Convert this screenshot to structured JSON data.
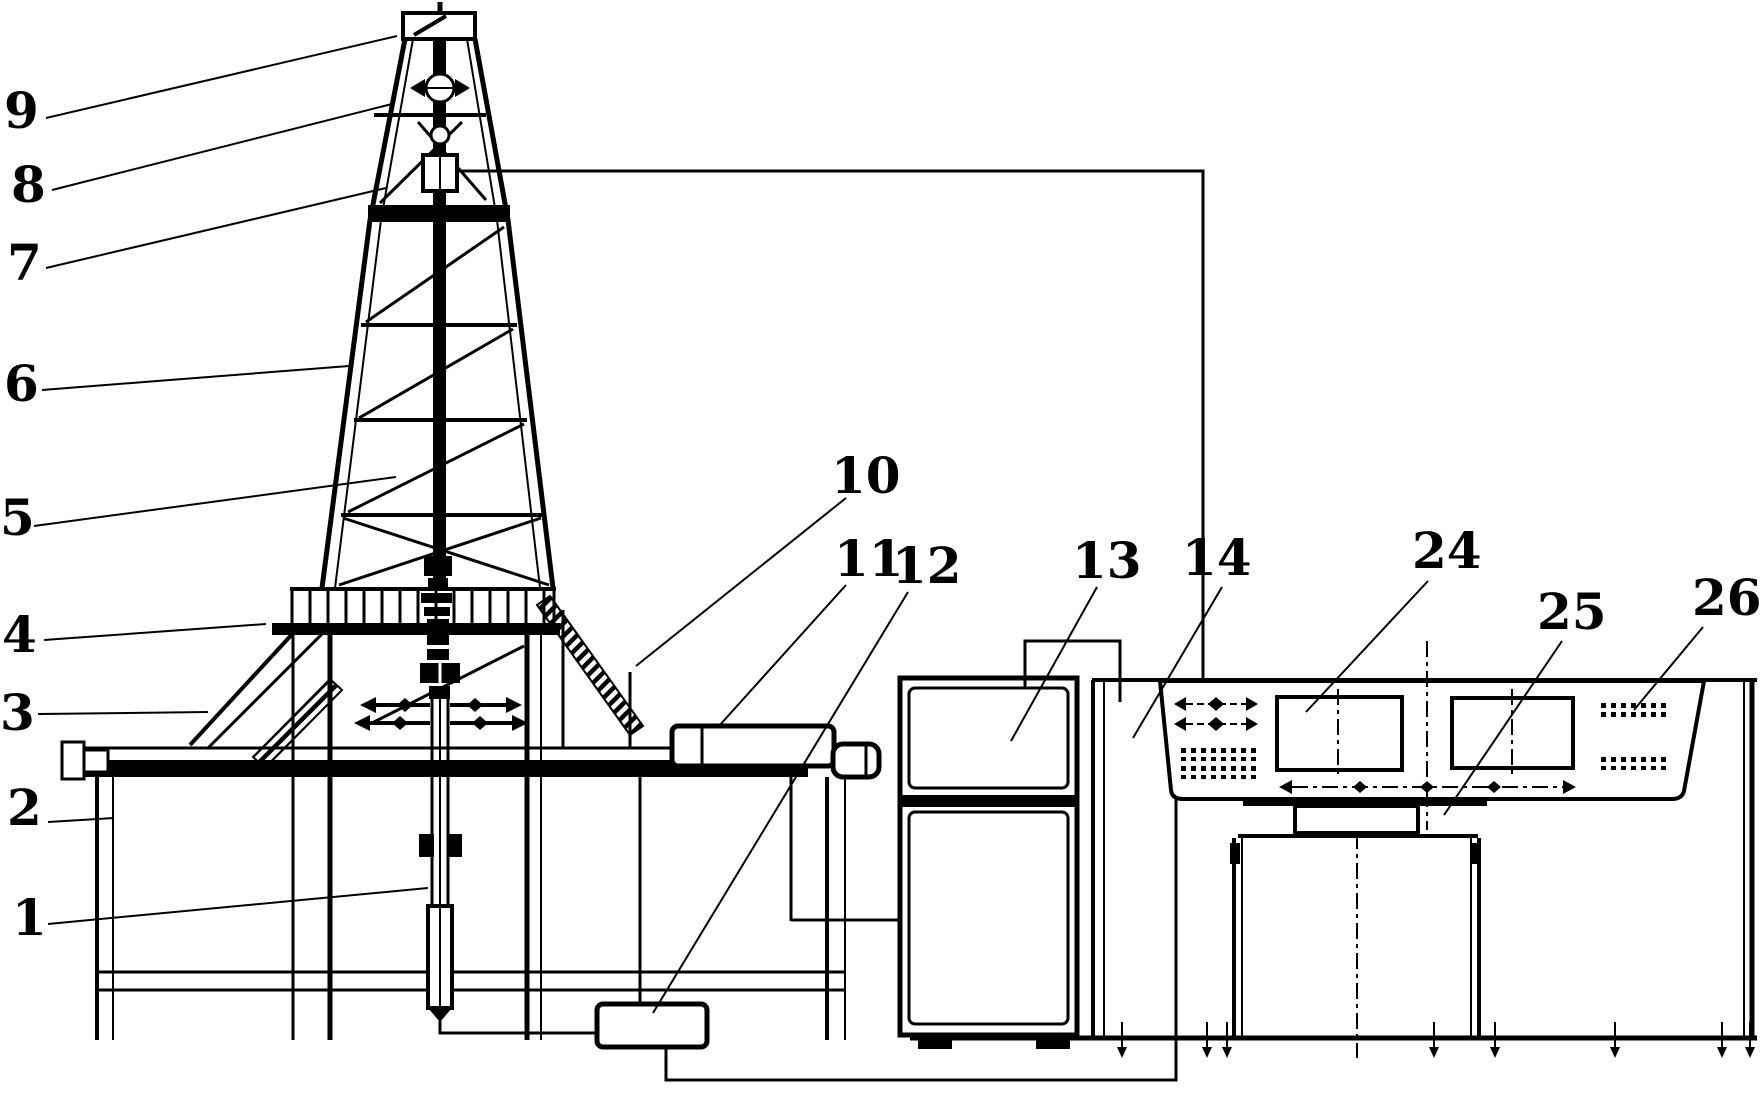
{
  "figure": {
    "kind": "patent-style technical line diagram of a drilling rig with derrick, instrument cabinet and driller console",
    "colors": {
      "ink": "#000000",
      "paper": "#ffffff"
    },
    "reference_labels": [
      {
        "text": "1"
      },
      {
        "text": "2"
      },
      {
        "text": "3"
      },
      {
        "text": "4"
      },
      {
        "text": "5"
      },
      {
        "text": "6"
      },
      {
        "text": "7"
      },
      {
        "text": "8"
      },
      {
        "text": "9"
      },
      {
        "text": "10"
      },
      {
        "text": "11"
      },
      {
        "text": "12"
      },
      {
        "text": "13"
      },
      {
        "text": "14"
      },
      {
        "text": "24"
      },
      {
        "text": "25"
      },
      {
        "text": "26"
      }
    ]
  }
}
